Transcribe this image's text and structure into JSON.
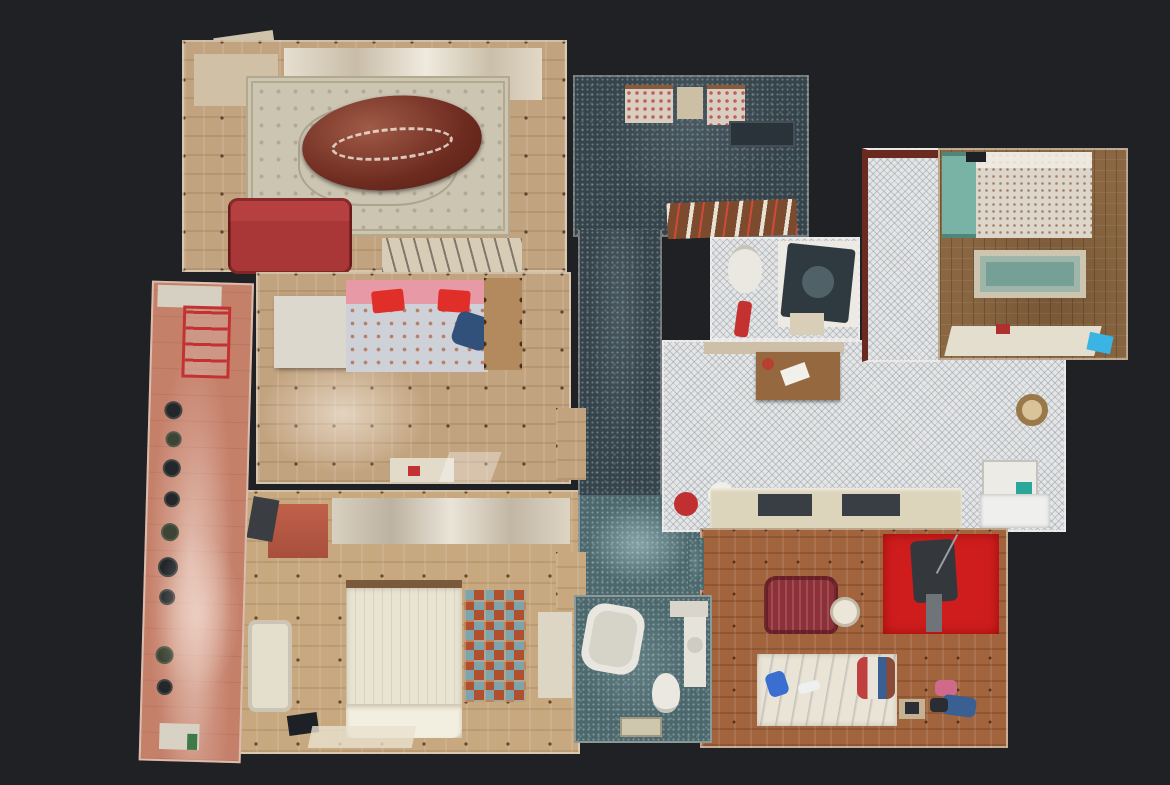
{
  "scene": {
    "view": "top-down 3D dollhouse scan of an apartment",
    "background": "dark charcoal"
  },
  "palette": {
    "bg": "#1f2125",
    "pql": "#c2a37f",
    "pqm": "#c7a87f",
    "pqb": "#8a6742",
    "pqo": "#a2643c",
    "tz": "#36434b",
    "tzt": "#4c686d",
    "mo": "#e3e5e6",
    "tc": "#c5806a",
    "rug": "#ccc5b2",
    "rugb": "#b3a98f",
    "rugteal": "#76a095",
    "rugred": "#cf1d1d",
    "sofa": "#a93737",
    "tbl": "#6e2c20",
    "bed": "#e9e3d2",
    "pink": "#e79aa6",
    "pred": "#df2f28",
    "tealp": "#79b3a5",
    "maroon": "#8d3038",
    "wht": "#eae8e1",
    "drk": "#2c3238",
    "wood": "#96683f",
    "counter": "#dcd5bc",
    "appl": "#2f3a40",
    "blue": "#31507a",
    "cyan": "#3ab4e4",
    "rchair": "#c23232",
    "pot": "#23272b"
  },
  "rooms": {
    "living": {
      "title": "Living room",
      "floor": "light parquet with ornate beige rug"
    },
    "bedroom_middle": {
      "title": "Bedroom with pink bed",
      "floor": "light parquet with dark inlays"
    },
    "bedroom_bottom": {
      "title": "Bedroom with double bed",
      "floor": "light parquet with dark inlays"
    },
    "balcony": {
      "title": "Balcony terrace with plant pots",
      "floor": "terracotta tile"
    },
    "hall": {
      "title": "Entrance hall",
      "floor": "dark speckled terrazzo"
    },
    "corridor": {
      "title": "Corridor",
      "floor": "dark speckled terrazzo"
    },
    "wc": {
      "title": "WC and laundry",
      "floor": "white mosaic tile"
    },
    "kitchen": {
      "title": "Kitchen",
      "floor": "white mosaic tile"
    },
    "passage": {
      "title": "Kitchen passage",
      "floor": "white mosaic tile"
    },
    "bedroom_right": {
      "title": "Bedroom with floral bed and teal rug",
      "floor": "brown parquet"
    },
    "study": {
      "title": "Study bedroom with red rug",
      "floor": "orange-brown parquet"
    },
    "bathroom": {
      "title": "Bathroom",
      "floor": "teal speckled terrazzo"
    }
  }
}
